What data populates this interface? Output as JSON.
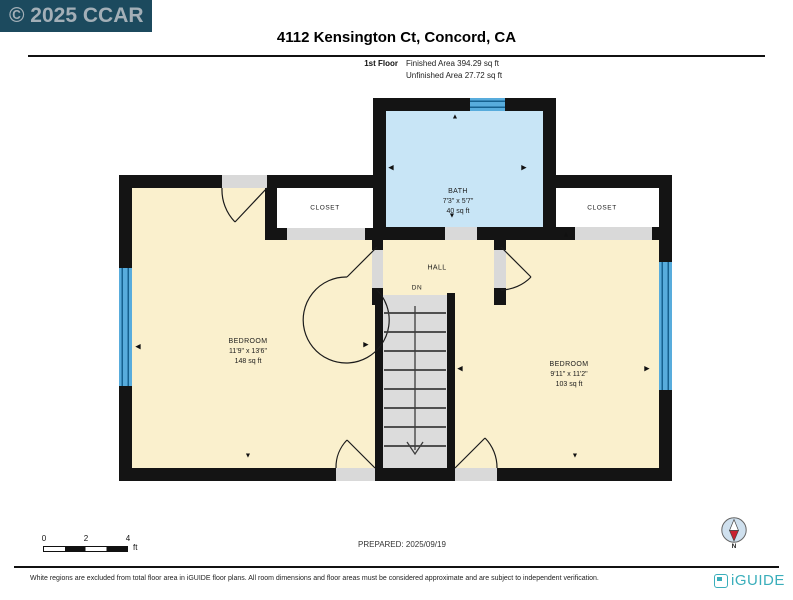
{
  "banner": {
    "text": "© 2025 CCAR"
  },
  "header": {
    "title": "4112 Kensington Ct, Concord, CA",
    "floor_label": "1st Floor",
    "finished_area": "Finished Area 394.29 sq ft",
    "unfinished_area": "Unfinished Area 27.72 sq ft"
  },
  "rooms": {
    "bath": {
      "name": "BATH",
      "dimensions": "7'3\" x 5'7\"",
      "area": "40 sq ft"
    },
    "closet_left": {
      "name": "CLOSET"
    },
    "closet_right": {
      "name": "CLOSET"
    },
    "hall": {
      "name": "HALL",
      "stairs_label": "DN"
    },
    "bedroom_left": {
      "name": "BEDROOM",
      "dimensions": "11'9\" x 13'6\"",
      "area": "148 sq ft"
    },
    "bedroom_right": {
      "name": "BEDROOM",
      "dimensions": "9'11\" x 11'2\"",
      "area": "103 sq ft"
    }
  },
  "scale_bar": {
    "ticks": [
      "0",
      "2",
      "4"
    ],
    "unit": "ft"
  },
  "prepared": "PREPARED: 2025/09/19",
  "compass": {
    "label": "N"
  },
  "footer": {
    "disclaimer": "White regions are excluded from total floor area in iGUIDE floor plans. All room dimensions and floor areas must be considered approximate and are subject to independent verification.",
    "brand": "iGUIDE"
  },
  "colors": {
    "banner_bg": "#1C4A5E",
    "banner_text": "#A3AFB7",
    "wall": "#141414",
    "room_fill": "#FAF0CD",
    "bath_fill": "#C8E5F6",
    "closet_fill": "#FFFFFF",
    "stair_fill": "#DCDCDC",
    "door_opening": "#D9D9D9",
    "window_glass": "#58ACDC",
    "window_frame": "#16618F",
    "brand_teal": "#3AAEBB",
    "compass_needle_red": "#C8202F"
  }
}
